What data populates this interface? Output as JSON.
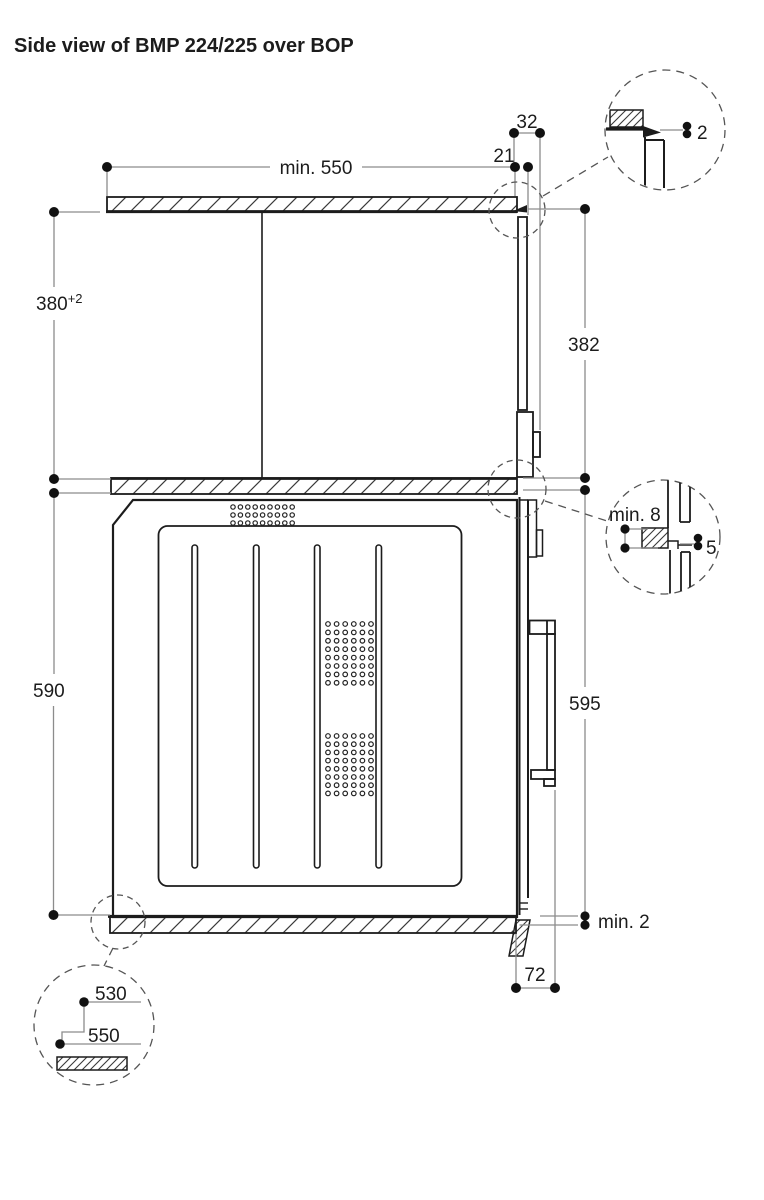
{
  "title": "Side view of BMP 224/225 over BOP",
  "colors": {
    "line": "#1c1c1c",
    "dimension": "#8c8c8c",
    "dashed": "#555555"
  },
  "dimensions": {
    "top_width": "min. 550",
    "top_gap": "21",
    "top_offset": "32",
    "upper_niche_height": "380",
    "upper_niche_tolerance": "+2",
    "right_upper_height": "382",
    "lower_niche_height": "590",
    "right_lower_height": "595",
    "bottom_gap": "min. 2",
    "door_protrusion": "72"
  },
  "details": {
    "top_right_gap": "2",
    "shelf_overhang": "min. 8",
    "front_gap": "5",
    "inner_depth": "530",
    "counter_depth": "550"
  }
}
